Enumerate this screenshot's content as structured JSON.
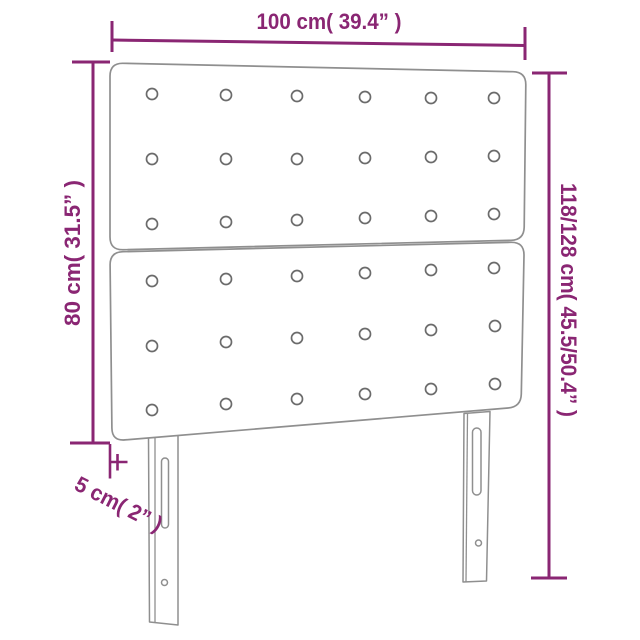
{
  "colors": {
    "accent": "#8a2673",
    "outline": "#8f8f8f",
    "button_outline": "#6b6b6b",
    "background": "#ffffff"
  },
  "figure": {
    "subject": "upholstered headboard with button tufting",
    "view": "front perspective line drawing",
    "panel_count": 2,
    "tufting_buttons_per_panel": 18,
    "leg_count": 2
  },
  "dimensions": {
    "width": {
      "label": "100 cm( 39.4” )",
      "cm": "100",
      "inches": "39.4"
    },
    "panel_height": {
      "label": "80 cm( 31.5” )",
      "cm": "80",
      "inches": "31.5"
    },
    "total_height": {
      "label": "118/128 cm( 45.5/50.4” )",
      "cm": "118/128",
      "inches": "45.5/50.4"
    },
    "thickness": {
      "label": "5 cm( 2” )",
      "cm": "5",
      "inches": "2"
    }
  }
}
